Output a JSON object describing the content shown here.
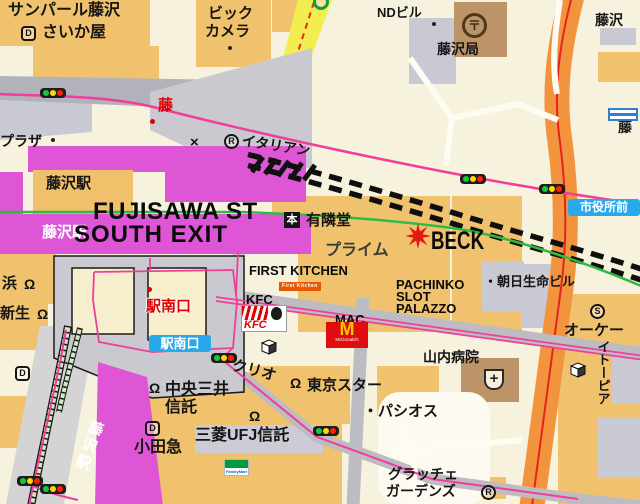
{
  "map": {
    "title": "Fujisawa Station South Exit area map",
    "palette": {
      "station_magenta": "#de55d6",
      "route_pink": "#ef3f9b",
      "rail_green": "#2dbb44",
      "road_orange": "#f2943e",
      "road_yellow": "#f3ee50",
      "accent_red": "#e10000",
      "bus_sign_blue": "#29a9e9"
    },
    "signs_static": {
      "shiyakusho": "市役所前",
      "ekinan": "駅南口"
    },
    "logos": {
      "kfc": "KFC",
      "mcdonalds_m": "M",
      "mcdonalds": "McDonald's",
      "first_kitchen": "First Kitchen",
      "familymart": "FamilyMart"
    },
    "labels": [
      {
        "name": "label-sunpearl-fujisawa",
        "text": "サンパール藤沢",
        "x": 8,
        "y": 3,
        "size": 16
      },
      {
        "name": "label-saikaya",
        "text": "さいか屋",
        "x": 42,
        "y": 25,
        "size": 16
      },
      {
        "name": "label-bic-camera-1",
        "text": "ビック",
        "x": 208,
        "y": 6,
        "size": 15
      },
      {
        "name": "label-bic-camera-2",
        "text": "カメラ",
        "x": 205,
        "y": 24,
        "size": 15
      },
      {
        "name": "label-nd-building",
        "text": "NDビル",
        "x": 377,
        "y": 6,
        "size": 13
      },
      {
        "name": "label-fujisawa-post-office",
        "text": "藤沢局",
        "x": 437,
        "y": 42,
        "size": 14
      },
      {
        "name": "label-fujisawa-topright",
        "text": "藤沢",
        "x": 595,
        "y": 13,
        "size": 14
      },
      {
        "name": "label-fuji-right-edge",
        "text": "藤",
        "x": 618,
        "y": 120,
        "size": 14
      },
      {
        "name": "label-fuji-red",
        "text": "藤",
        "x": 158,
        "y": 98,
        "size": 15,
        "color": "#e10000",
        "w": 700
      },
      {
        "name": "label-plaza",
        "text": "プラザ",
        "x": 0,
        "y": 134,
        "size": 14
      },
      {
        "name": "label-fujisawa-station-1",
        "text": "藤沢駅",
        "x": 46,
        "y": 176,
        "size": 15
      },
      {
        "name": "label-fujisawa-station-2",
        "text": "藤沢駅",
        "x": 42,
        "y": 225,
        "size": 15,
        "color": "#ffffff"
      },
      {
        "name": "label-fujisawa-st",
        "text": "FUJISAWA ST",
        "x": 93,
        "y": 200,
        "size": 24,
        "w": 700,
        "ls": 0.5,
        "color": "#0a0a0a"
      },
      {
        "name": "label-south-exit",
        "text": "SOUTH EXIT",
        "x": 74,
        "y": 223,
        "size": 24,
        "w": 700,
        "ls": 1,
        "color": "#0a0a0a"
      },
      {
        "name": "label-x-mark",
        "text": "×",
        "x": 190,
        "y": 135,
        "size": 15,
        "w": 700
      },
      {
        "name": "label-italian",
        "text": "イタリアン",
        "x": 243,
        "y": 133,
        "size": 14,
        "rot": 9
      },
      {
        "name": "label-yurindo",
        "text": "有隣堂",
        "x": 306,
        "y": 213,
        "size": 15
      },
      {
        "name": "label-prime",
        "text": "プライム",
        "x": 325,
        "y": 243,
        "size": 16,
        "color": "#3a3a3a"
      },
      {
        "name": "label-beck",
        "text": "BECK",
        "x": 431,
        "y": 228,
        "size": 25,
        "w": 700,
        "sx": 0.75,
        "color": "#0a0a0a"
      },
      {
        "name": "label-first-kitchen",
        "text": "FIRST KITCHEN",
        "x": 249,
        "y": 264,
        "size": 13,
        "w": 700,
        "color": "#0a0a0a"
      },
      {
        "name": "label-kfc",
        "text": "KFC",
        "x": 246,
        "y": 293,
        "size": 13,
        "w": 700,
        "color": "#0a0a0a"
      },
      {
        "name": "label-mac",
        "text": "MAC",
        "x": 335,
        "y": 313,
        "size": 13,
        "w": 700,
        "color": "#0a0a0a"
      },
      {
        "name": "label-pachinko",
        "text": "PACHINKO",
        "x": 396,
        "y": 278,
        "size": 13,
        "w": 700,
        "color": "#0a0a0a"
      },
      {
        "name": "label-slot",
        "text": "SLOT",
        "x": 396,
        "y": 290,
        "size": 13,
        "w": 700,
        "color": "#0a0a0a"
      },
      {
        "name": "label-palazzo",
        "text": "PALAZZO",
        "x": 396,
        "y": 302,
        "size": 13,
        "w": 700,
        "color": "#0a0a0a"
      },
      {
        "name": "label-asahi-seimei",
        "text": "・朝日生命ビル",
        "x": 484,
        "y": 275,
        "size": 13
      },
      {
        "name": "label-ok-store",
        "text": "オーケー",
        "x": 564,
        "y": 323,
        "size": 15
      },
      {
        "name": "label-itopia",
        "text": "イトーピア",
        "x": 596,
        "y": 340,
        "size": 13,
        "vert": true
      },
      {
        "name": "label-yamauchi-hospital",
        "text": "山内病院",
        "x": 423,
        "y": 350,
        "size": 14
      },
      {
        "name": "label-pasios",
        "text": "・パシオス",
        "x": 363,
        "y": 404,
        "size": 15
      },
      {
        "name": "label-grazie-1",
        "text": "グラッチェ",
        "x": 388,
        "y": 467,
        "size": 14
      },
      {
        "name": "label-grazie-2",
        "text": "ガーデンズ",
        "x": 386,
        "y": 484,
        "size": 14
      },
      {
        "name": "label-tokyo-star",
        "text": "東京スター",
        "x": 307,
        "y": 378,
        "size": 15
      },
      {
        "name": "label-chuo-mitsui-1",
        "text": "中央三井",
        "x": 165,
        "y": 382,
        "size": 16
      },
      {
        "name": "label-chuo-mitsui-2",
        "text": "信託",
        "x": 165,
        "y": 400,
        "size": 16
      },
      {
        "name": "label-odakyu",
        "text": "小田急",
        "x": 134,
        "y": 440,
        "size": 16
      },
      {
        "name": "label-mitsubishi-ufj",
        "text": "三菱UFJ信託",
        "x": 195,
        "y": 428,
        "size": 16
      },
      {
        "name": "label-clio",
        "text": "クリオ",
        "x": 234,
        "y": 358,
        "size": 15,
        "rot": 14
      },
      {
        "name": "label-ekinan-exit-red",
        "text": "駅南口",
        "x": 146,
        "y": 299,
        "size": 15,
        "color": "#e10000",
        "w": 700,
        "halo": true
      },
      {
        "name": "label-hama-bank",
        "text": "浜",
        "x": 2,
        "y": 276,
        "size": 15
      },
      {
        "name": "label-shinsei-bank",
        "text": "新生",
        "x": 0,
        "y": 306,
        "size": 15
      },
      {
        "name": "label-enoden-fujisawa-station",
        "text": "藤沢駅",
        "x": 90,
        "y": 418,
        "size": 15,
        "color": "#ffffff",
        "vert": true,
        "rot": 20,
        "ls": 3
      }
    ],
    "icons": [
      {
        "name": "daiei-mark-saikaya-icon",
        "type": "circle-letter",
        "letter": "D",
        "shape": "square",
        "x": 21,
        "y": 26
      },
      {
        "name": "d-mark-southwest-icon",
        "type": "circle-letter",
        "letter": "D",
        "shape": "square",
        "x": 15,
        "y": 366
      },
      {
        "name": "d-mark-odakyu-icon",
        "type": "circle-letter",
        "letter": "D",
        "shape": "square",
        "x": 145,
        "y": 421
      },
      {
        "name": "restaurant-mark-italian-icon",
        "type": "circle-letter",
        "letter": "R",
        "x": 224,
        "y": 134
      },
      {
        "name": "restaurant-mark-grazie-icon",
        "type": "circle-letter",
        "letter": "R",
        "x": 481,
        "y": 485
      },
      {
        "name": "s-mark-ok-store-icon",
        "type": "circle-letter",
        "letter": "S",
        "x": 590,
        "y": 304
      },
      {
        "name": "bookstore-mark-yurindo-icon",
        "type": "square-letter",
        "letter": "本",
        "x": 284,
        "y": 212
      },
      {
        "name": "post-office-icon",
        "type": "post-office",
        "glyph": "〒",
        "x": 462,
        "y": 13
      },
      {
        "name": "hospital-icon",
        "type": "hospital",
        "x": 484,
        "y": 369
      },
      {
        "name": "building-cube-clio-icon",
        "type": "cube",
        "x": 259,
        "y": 338
      },
      {
        "name": "building-cube-itopia-icon",
        "type": "cube",
        "x": 568,
        "y": 361
      },
      {
        "name": "beck-star-icon",
        "type": "star",
        "x": 404,
        "y": 222
      },
      {
        "name": "bank-mark-hama-icon",
        "type": "bank",
        "x": 24,
        "y": 278
      },
      {
        "name": "bank-mark-shinsei-icon",
        "type": "bank",
        "x": 37,
        "y": 308
      },
      {
        "name": "bank-mark-chuo-mitsui-icon",
        "type": "bank",
        "x": 149,
        "y": 382
      },
      {
        "name": "bank-mark-mufj-icon",
        "type": "bank",
        "x": 249,
        "y": 410
      },
      {
        "name": "bank-mark-tokyo-star-icon",
        "type": "bank",
        "x": 290,
        "y": 377
      },
      {
        "name": "traffic-light-northwest-icon",
        "type": "traffic-light",
        "x": 40,
        "y": 88
      },
      {
        "name": "traffic-light-prime-icon",
        "type": "traffic-light",
        "x": 460,
        "y": 174
      },
      {
        "name": "traffic-light-shiyakusho-icon",
        "type": "traffic-light",
        "x": 539,
        "y": 184
      },
      {
        "name": "traffic-light-rotary-icon",
        "type": "traffic-light",
        "x": 211,
        "y": 353
      },
      {
        "name": "traffic-light-ufj-icon",
        "type": "traffic-light",
        "x": 313,
        "y": 426
      },
      {
        "name": "traffic-light-enoden-1-icon",
        "type": "traffic-light",
        "x": 17,
        "y": 476
      },
      {
        "name": "traffic-light-enoden-2-icon",
        "type": "traffic-light",
        "x": 40,
        "y": 484
      },
      {
        "name": "dot-bic-camera",
        "type": "dot",
        "color": "#222222",
        "size": 4,
        "x": 228,
        "y": 46
      },
      {
        "name": "dot-nd-building",
        "type": "dot",
        "color": "#222222",
        "size": 4,
        "x": 432,
        "y": 22
      },
      {
        "name": "dot-plaza",
        "type": "dot",
        "color": "#222222",
        "size": 4,
        "x": 51,
        "y": 138
      },
      {
        "name": "dot-fuji-red",
        "type": "dot",
        "color": "#e10000",
        "size": 5,
        "x": 150,
        "y": 119
      },
      {
        "name": "dot-rotary-red",
        "type": "dot",
        "color": "#e10000",
        "size": 5,
        "x": 147,
        "y": 287
      },
      {
        "name": "green-circle-north-icon",
        "type": "green-circle",
        "x": 313,
        "y": -6
      },
      {
        "name": "boundary-sign-icon",
        "type": "boundary-sign",
        "x": 608,
        "y": 108
      },
      {
        "name": "kfc-logo",
        "type": "kfc-logo",
        "x": 241,
        "y": 305
      },
      {
        "name": "mcdonalds-logo",
        "type": "mcdonalds-logo",
        "x": 326,
        "y": 322
      },
      {
        "name": "first-kitchen-logo",
        "type": "first-kitchen-banner",
        "x": 279,
        "y": 282
      },
      {
        "name": "familymart-logo",
        "type": "familymart-logo",
        "x": 224,
        "y": 459
      }
    ]
  }
}
